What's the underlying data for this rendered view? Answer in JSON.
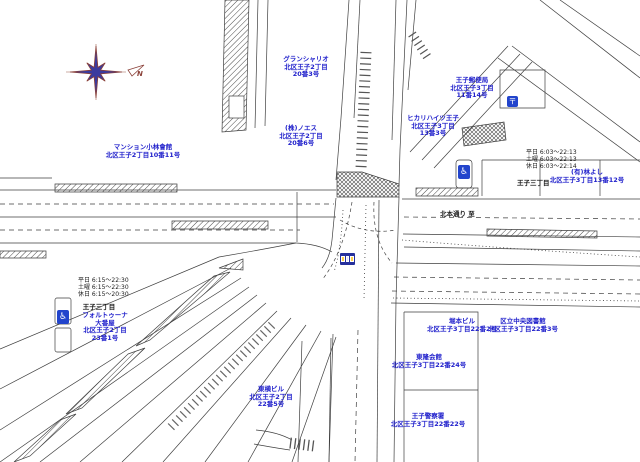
{
  "colors": {
    "label_blue": "#2222cc",
    "text_black": "#1a1a1a",
    "line_dark": "#3f3f3f",
    "compass_blue": "#3b3b9e",
    "compass_red": "#8a4038",
    "icon_blue": "#2244cc"
  },
  "compass": {
    "north_label": "N"
  },
  "street": {
    "label": "北本通り 至"
  },
  "schedules": {
    "left": {
      "rows": [
        "平日 6:15〜22:30",
        "土曜 6:15〜22:30",
        "休日 6:15〜20:30"
      ],
      "stop": "王子三丁目"
    },
    "right": {
      "rows": [
        "平日 6:03〜22:13",
        "土曜 6:03〜22:13",
        "休日 6:03〜22:14"
      ],
      "stop": "王子三丁目"
    }
  },
  "labels": [
    {
      "id": "gran-chariot",
      "lines": [
        "グランシャリオ",
        "北区王子2丁目",
        "20番3号"
      ]
    },
    {
      "id": "noesu",
      "lines": [
        "(株)ノエス",
        "北区王子2丁目",
        "20番6号"
      ]
    },
    {
      "id": "hikari-heights",
      "lines": [
        "ヒカリハイツ王子",
        "北区王子3丁目",
        "13番3号"
      ]
    },
    {
      "id": "oji-post-office",
      "lines": [
        "王子郵便局",
        "北区王子3丁目",
        "11番14号"
      ]
    },
    {
      "id": "hayashi-yoshi",
      "lines": [
        "(有)林よし",
        "北区王子3丁目13番12号"
      ]
    },
    {
      "id": "mansion-kobayashi",
      "lines": [
        "マンション小林會館",
        "北区王子2丁目10番11号"
      ]
    },
    {
      "id": "fortuna",
      "lines": [
        "フォルトゥーナ",
        "大番屋",
        "北区王子2丁目",
        "23番1号"
      ]
    },
    {
      "id": "horimoto-building",
      "lines": [
        "堀本ビル",
        "北区王子3丁目22番2号"
      ]
    },
    {
      "id": "central-library",
      "lines": [
        "区立中央図書館",
        "北区王子3丁目22番3号"
      ]
    },
    {
      "id": "toryu-kaikan",
      "lines": [
        "東隆会館",
        "北区王子3丁目22番24号"
      ]
    },
    {
      "id": "toyoko-building",
      "lines": [
        "東横ビル",
        "北区王子2丁目",
        "22番5号"
      ]
    },
    {
      "id": "oji-police",
      "lines": [
        "王子警察署",
        "北区王子3丁目22番22号"
      ]
    }
  ],
  "icons": {
    "wheelchair_glyph": "♿",
    "post_glyph": "〒",
    "names": [
      "compass-rose",
      "north-pennant",
      "wheelchair-icon-left",
      "wheelchair-icon-right",
      "post-office-icon",
      "station-entrance-icon"
    ]
  }
}
